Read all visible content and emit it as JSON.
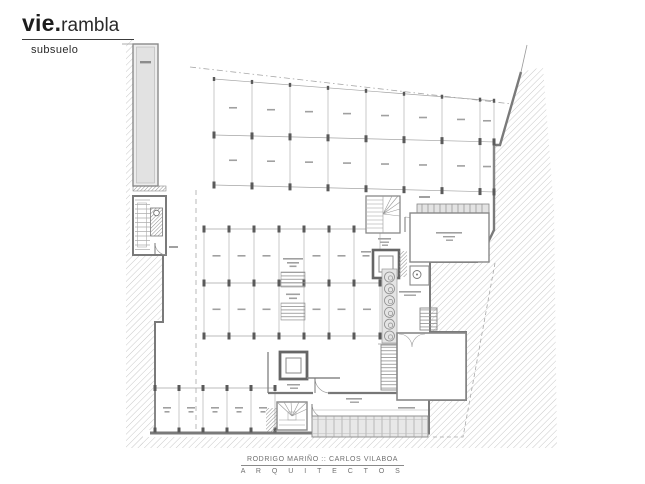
{
  "header": {
    "brand_bold": "vie.",
    "brand_light": "rambla",
    "level": "subsuelo"
  },
  "footer": {
    "architects": "RODRIGO MARIÑO :: CARLOS VILABOA",
    "studio": "A R Q U I T E C T O S"
  },
  "colors": {
    "paper": "#ffffff",
    "ink": "#1d1d1d",
    "wall_dark": "#5a5a5a",
    "wall_mid": "#7d7d7d",
    "line_thin": "#a5a5a5",
    "hatch": "#c9c9c9",
    "fill_light": "#e8e8e8",
    "footer_text": "#6f6f6f"
  }
}
